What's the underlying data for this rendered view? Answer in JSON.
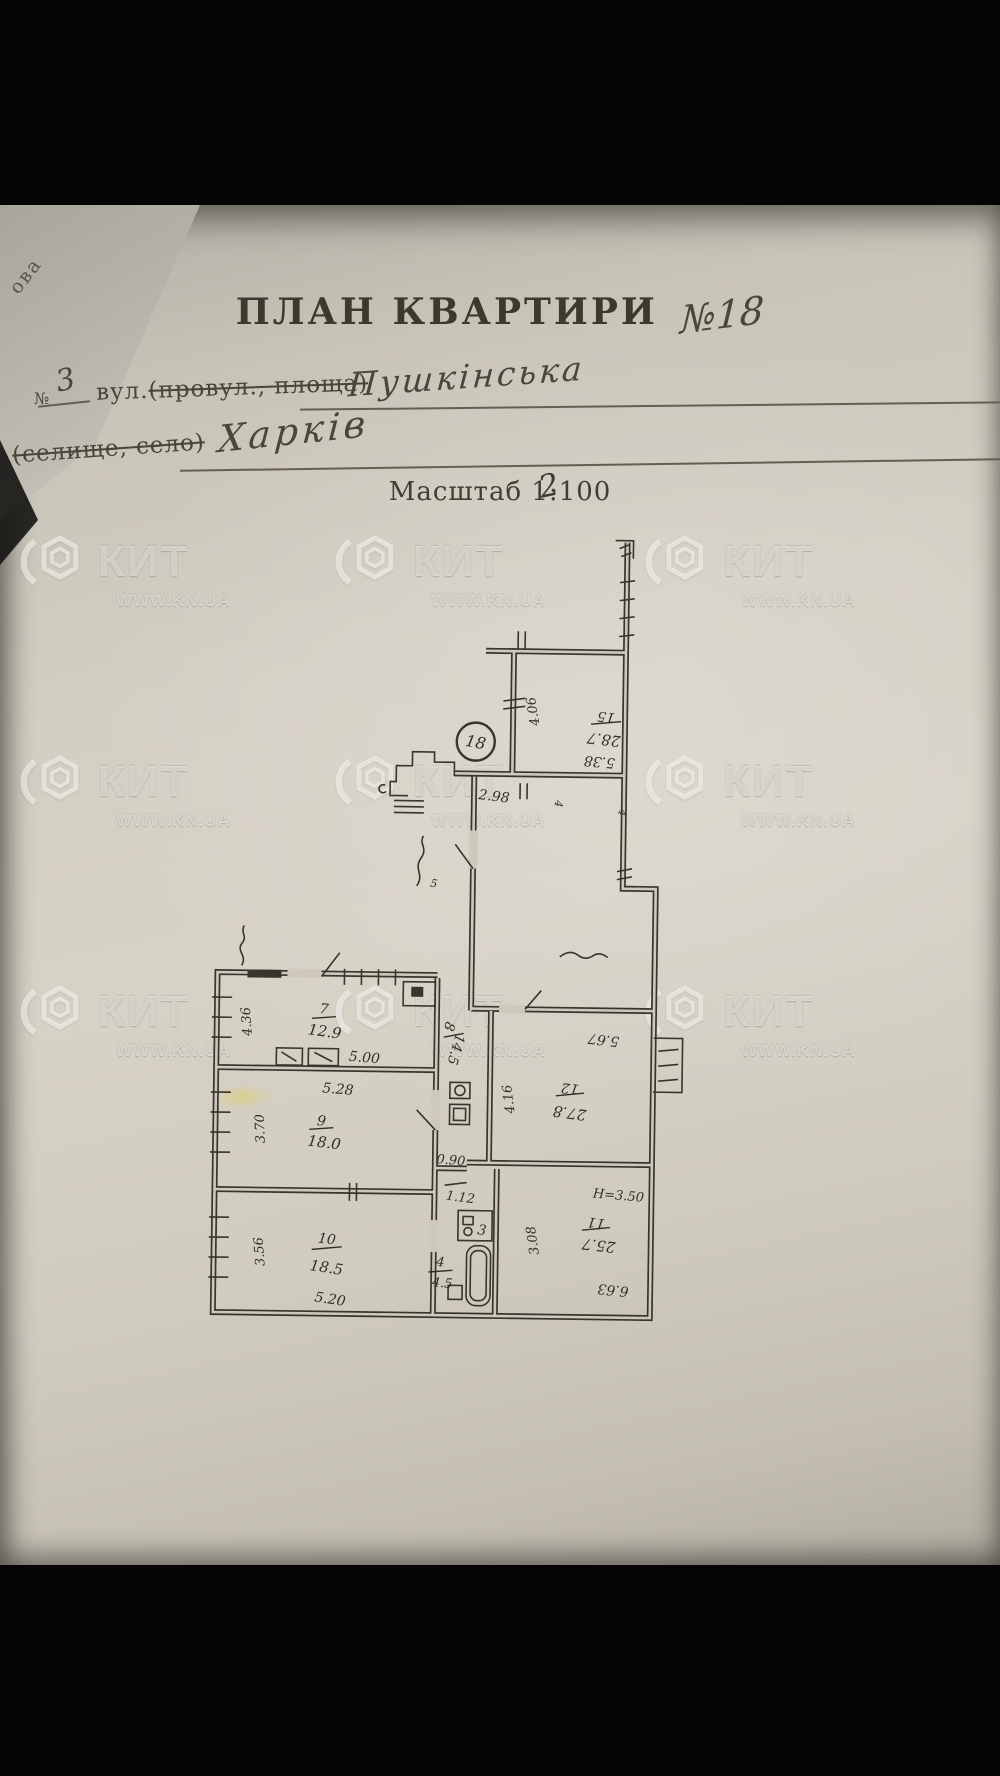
{
  "photo": {
    "corner_fragment": "ова"
  },
  "document": {
    "title": "ПЛАН КВАРТИРИ",
    "apartment_no": "№18",
    "line1": {
      "no_label": "№",
      "no_value": "3",
      "prefix": "вул.",
      "struck": "(провул., площа)",
      "value": "Пушкінська"
    },
    "line2": {
      "struck": "(селище, село)",
      "value": "Харків"
    },
    "scale": {
      "text": "Масштаб 1:100",
      "correction": "2"
    }
  },
  "watermark": {
    "brand": "КИТ",
    "url": "WWW.KN.UA"
  },
  "plan": {
    "badge": "18",
    "r15": {
      "no": "15",
      "area": "28.7",
      "w": "5.38",
      "h": "4.06"
    },
    "vestibule": {
      "w": "2.98"
    },
    "r7": {
      "no": "7",
      "area": "12.9",
      "w": "5.00",
      "h": "4.36"
    },
    "r8": {
      "no": "8",
      "area": "14.5"
    },
    "r9": {
      "no": "9",
      "area": "18.0",
      "w": "5.28",
      "h": "3.70"
    },
    "r10": {
      "no": "10",
      "area": "18.5",
      "w": "5.20",
      "h": "3.56"
    },
    "r11": {
      "no": "11",
      "area": "25.7",
      "w": "6.63",
      "h": "3.08",
      "ceiling": "H=3.50"
    },
    "r12": {
      "no": "12",
      "area": "27.8",
      "w": "5.67",
      "h": "4.16"
    },
    "wc": {
      "no": "3"
    },
    "bath": {
      "no": "4",
      "area": "4.5"
    },
    "dims": {
      "d090": "0.90",
      "d112": "1.12"
    },
    "marks": {
      "m4a": "4",
      "m4b": "4",
      "m5": "5"
    }
  }
}
